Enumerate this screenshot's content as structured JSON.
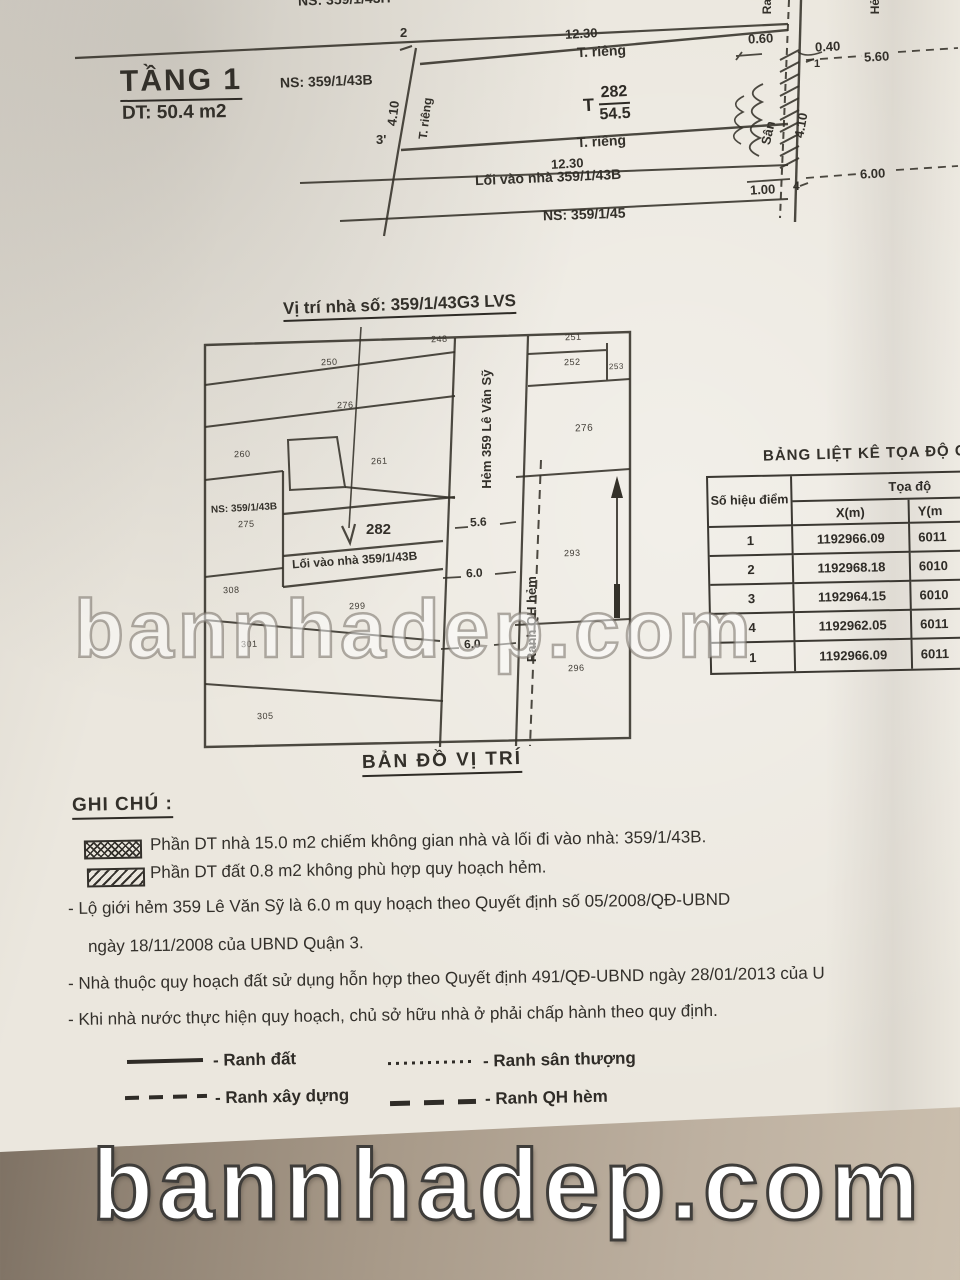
{
  "floorplan": {
    "title": "TẦNG 1",
    "area": "DT: 50.4 m2",
    "ns_top": "NS: 359/1/43H",
    "ns_left": "NS: 359/1/43B",
    "ns_bottom": "NS: 359/1/45",
    "dim_top": "12.30",
    "dim_bottom": "12.30",
    "t_rieng_top": "T. riêng",
    "t_rieng_bottom": "T. riêng",
    "t_rieng_left": "T. riêng",
    "parcel_t": "T",
    "parcel_number": "282",
    "parcel_area": "54.5",
    "loi_vao": "Lối vào nhà 359/1/43B",
    "san": "Sân",
    "d060": "0.60",
    "d040": "0.40",
    "d560": "5.60",
    "d600": "6.00",
    "d100": "1.00",
    "d410_left": "4.10",
    "d410_right": "4.10",
    "pt1": "1",
    "pt2": "2",
    "pt3": "3'",
    "pt4": "4",
    "ranh_cut": "Ra",
    "hem_cut": "Hẻ"
  },
  "map": {
    "title": "Vị trí nhà số: 359/1/43G3 LVS",
    "caption": "BẢN ĐỒ VỊ TRÍ",
    "hem_label": "Hẻm 359 Lê Văn Sỹ",
    "ranh_qh_label": "Ranh QH hẻm",
    "loi_vao": "Lối vào nhà 359/1/43B",
    "ns43b": "NS: 359/1/43B",
    "d56": "5.6",
    "d60a": "6.0",
    "d60b": "6.0",
    "parcels": {
      "p248": "248",
      "p250": "250",
      "p251": "251",
      "p252": "252",
      "p253": "253",
      "p260": "260",
      "p261": "261",
      "p275": "275",
      "p276l": "276",
      "p276r": "276",
      "p282": "282",
      "p293": "293",
      "p296": "296",
      "p299": "299",
      "p301": "301",
      "p305": "305",
      "p308": "308"
    }
  },
  "table": {
    "title": "BẢNG LIỆT KÊ TỌA ĐỘ G",
    "col_point": "Số hiệu điểm",
    "col_coords": "Tọa độ",
    "col_x": "X(m)",
    "col_y": "Y(m",
    "rows": [
      {
        "pt": "1",
        "x": "1192966.09",
        "y": "6011"
      },
      {
        "pt": "2",
        "x": "1192968.18",
        "y": "6010"
      },
      {
        "pt": "3",
        "x": "1192964.15",
        "y": "6010"
      },
      {
        "pt": "4",
        "x": "1192962.05",
        "y": "6011"
      },
      {
        "pt": "1",
        "x": "1192966.09",
        "y": "6011"
      }
    ]
  },
  "notes": {
    "heading": "GHI CHÚ :",
    "hatch1": "Phần DT nhà 15.0 m2 chiếm không gian nhà và lối đi vào nhà: 359/1/43B.",
    "hatch2": "Phần DT đất 0.8 m2 không phù hợp quy hoạch hẻm.",
    "l1": "- Lộ giới hẻm 359 Lê Văn Sỹ là 6.0 m quy hoạch theo Quyết định số 05/2008/QĐ-UBND",
    "l2": "ngày 18/11/2008 của UBND Quận 3.",
    "l3": "- Nhà thuộc quy hoạch đất sử dụng hỗn hợp theo Quyết định 491/QĐ-UBND ngày 28/01/2013 của U",
    "l4": "- Khi nhà nước thực hiện quy hoạch, chủ sở hữu nhà ở phải chấp hành theo quy định."
  },
  "legend": {
    "ranh_dat": "- Ranh đất",
    "ranh_xay_dung": "- Ranh xây dựng",
    "ranh_san_thuong": "- Ranh sân thượng",
    "ranh_qh_hem": "- Ranh QH hèm"
  },
  "watermark": {
    "text": "bannhadep.com"
  },
  "colors": {
    "paper": "#ebe7de",
    "ink": "#33302a",
    "photo_background": "#a89a89"
  }
}
